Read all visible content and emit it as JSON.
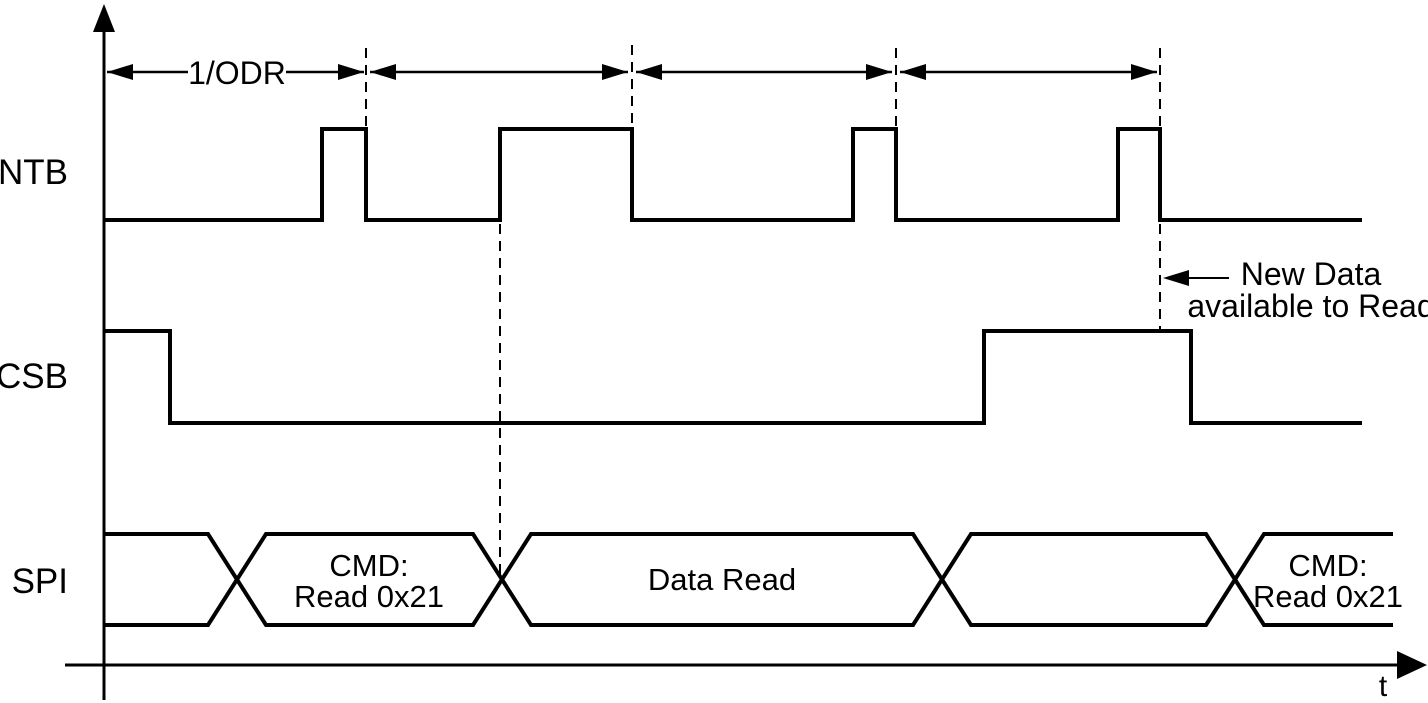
{
  "diagram": {
    "type": "timing-diagram",
    "background_color": "#ffffff",
    "line_color": "#000000",
    "time_axis_label": "t",
    "period_label": "1/ODR",
    "signals": [
      {
        "name": "INTB"
      },
      {
        "name": "CSB"
      },
      {
        "name": "SPI"
      }
    ],
    "spi_bus": {
      "segments": [
        {
          "label_line1": "",
          "label_line2": ""
        },
        {
          "label_line1": "CMD:",
          "label_line2": "Read 0x21"
        },
        {
          "label_line1": "Data Read",
          "label_line2": ""
        },
        {
          "label_line1": "",
          "label_line2": ""
        },
        {
          "label_line1": "CMD:",
          "label_line2": "Read 0x21"
        }
      ]
    },
    "annotation": {
      "line1": "New Data",
      "line2": "available to Read"
    }
  }
}
